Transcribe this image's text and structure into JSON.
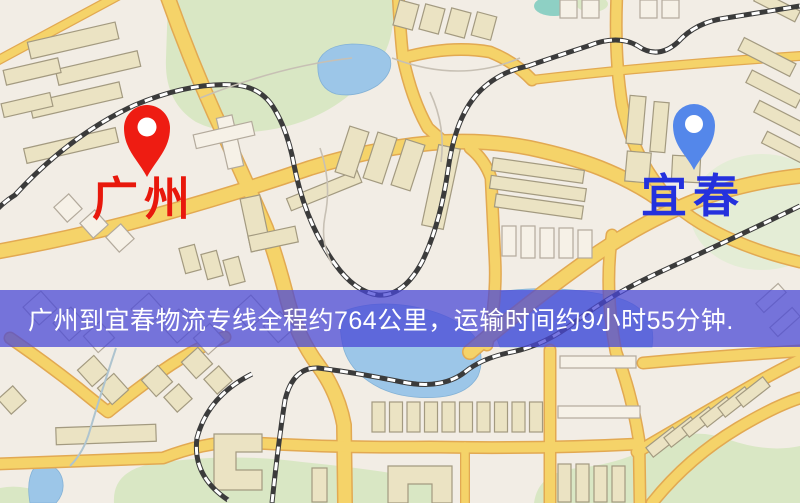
{
  "map": {
    "origin": {
      "label": "广州",
      "marker": "red-map-pin"
    },
    "destination": {
      "label": "宜春",
      "marker": "blue-map-pin"
    }
  },
  "banner": {
    "text": "广州到宜春物流专线全程约764公里，运输时间约9小时55分钟."
  },
  "colors": {
    "marker_red": "#ee1c12",
    "marker_blue": "#5487ea",
    "label_red": "#e8180c",
    "label_blue": "#2431dd",
    "banner_overlay": "#4947d6",
    "banner_text": "#ffffff",
    "road_fill": "#f5d369",
    "road_casing": "#e2a952",
    "water": "#9cc6e8",
    "park": "#d9e7c4",
    "building_fill": "#ebe3c3",
    "building_stroke": "#a39a80",
    "map_background": "#f2ede5"
  }
}
